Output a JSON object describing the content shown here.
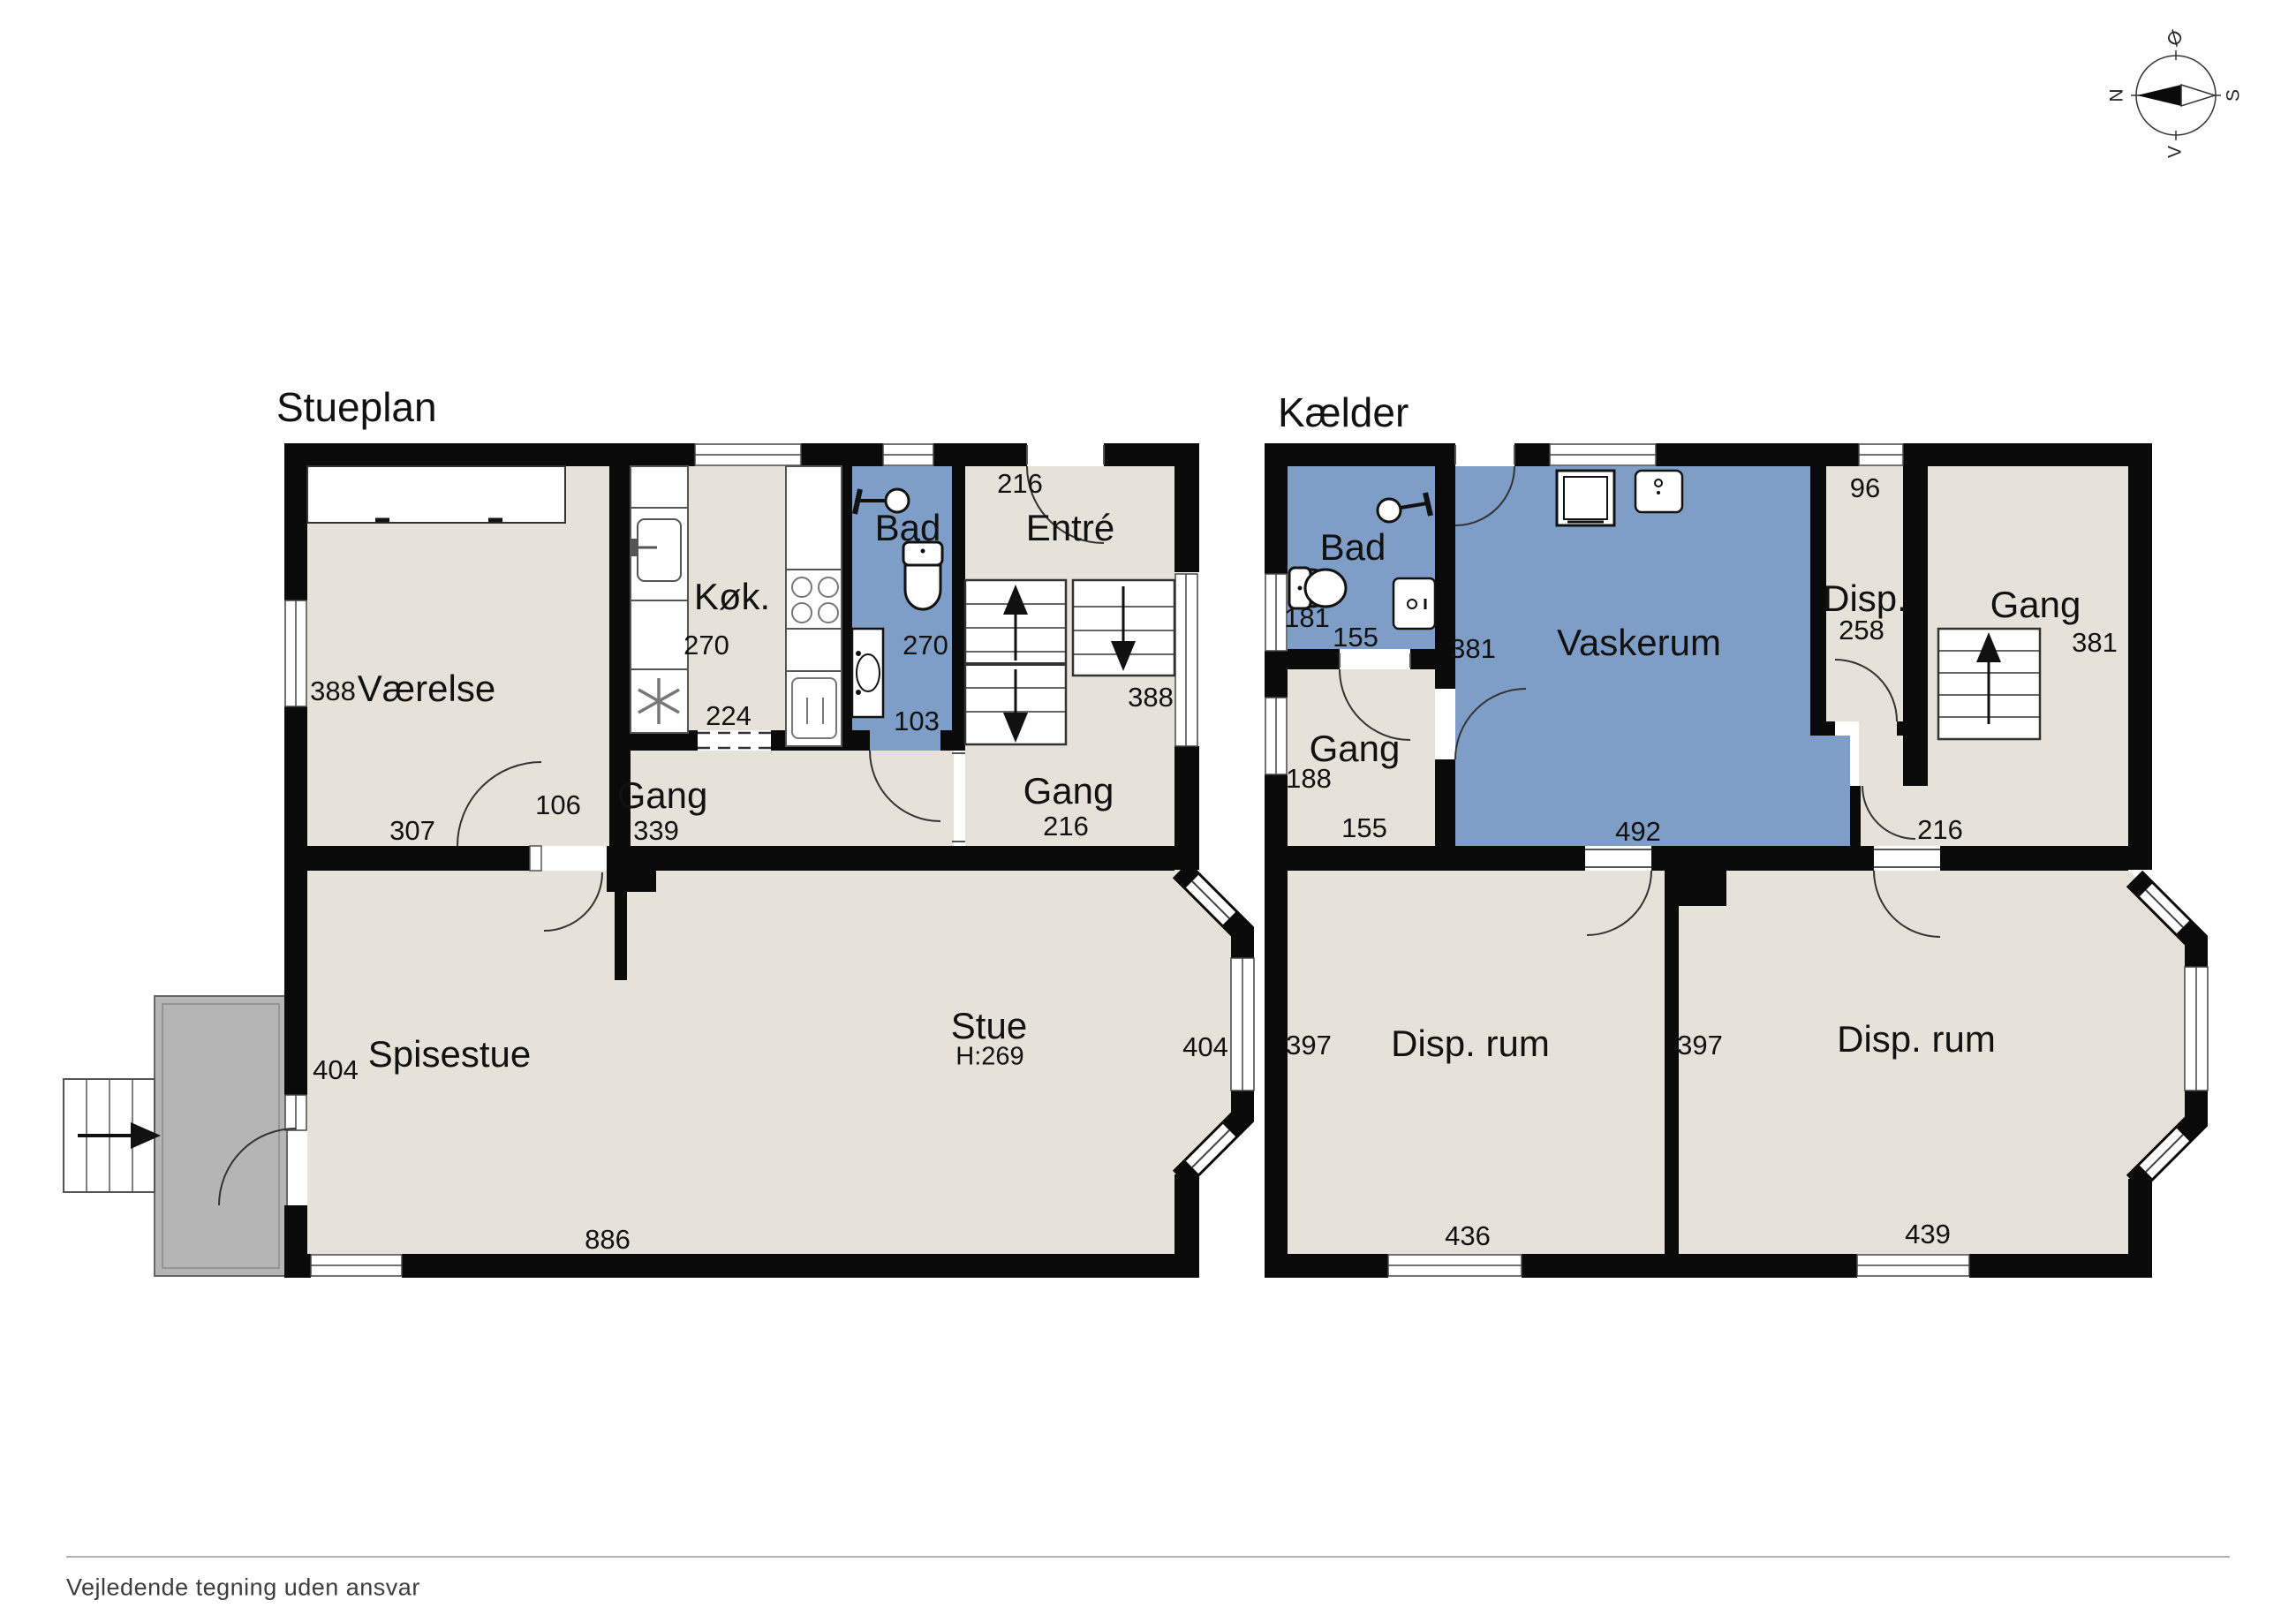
{
  "colors": {
    "wall": "#0a0a0a",
    "floor": "#e6e2d9",
    "wet_room": "#7f9ec7",
    "terrace": "#b5b5b5",
    "background": "#ffffff"
  },
  "footer": {
    "disclaimer": "Vejledende tegning uden ansvar"
  },
  "compass": {
    "north": "N",
    "east": "Ø",
    "south": "S",
    "west": "V"
  },
  "stueplan": {
    "title": "Stueplan",
    "rooms": {
      "vaerelse": {
        "label": "Værelse",
        "dim_height": "388",
        "dim_width": "307"
      },
      "koek": {
        "label": "Køk.",
        "dim_height": "270",
        "dim_width": "224"
      },
      "bad": {
        "label": "Bad",
        "dim_height": "270",
        "dim_width": "103"
      },
      "entre": {
        "label": "Entré",
        "dim_door": "216",
        "dim_height": "388"
      },
      "gang": {
        "label": "Gang",
        "dim_width": "339",
        "dim_door": "106"
      },
      "gang_east": {
        "label": "Gang",
        "dim_width": "216"
      },
      "spisestue": {
        "label": "Spisestue",
        "dim_height": "404"
      },
      "stue": {
        "label": "Stue",
        "ceiling_height": "H:269",
        "dim_height": "404",
        "dim_width": "886"
      }
    }
  },
  "kaelder": {
    "title": "Kælder",
    "rooms": {
      "bad": {
        "label": "Bad",
        "dim_height": "181",
        "dim_width": "155"
      },
      "gang": {
        "label": "Gang",
        "dim_height": "188",
        "dim_width": "155"
      },
      "vaskerum": {
        "label": "Vaskerum",
        "dim_height": "381",
        "dim_width": "492"
      },
      "disp": {
        "label": "Disp.",
        "dim_height": "258",
        "dim_width": "96"
      },
      "gang_east": {
        "label": "Gang",
        "dim_height": "381",
        "dim_width": "216"
      },
      "disp_rum_vest": {
        "label": "Disp. rum",
        "dim_height": "397",
        "dim_width": "436"
      },
      "disp_rum_oest": {
        "label": "Disp. rum",
        "dim_height": "397",
        "dim_width": "439"
      }
    }
  }
}
